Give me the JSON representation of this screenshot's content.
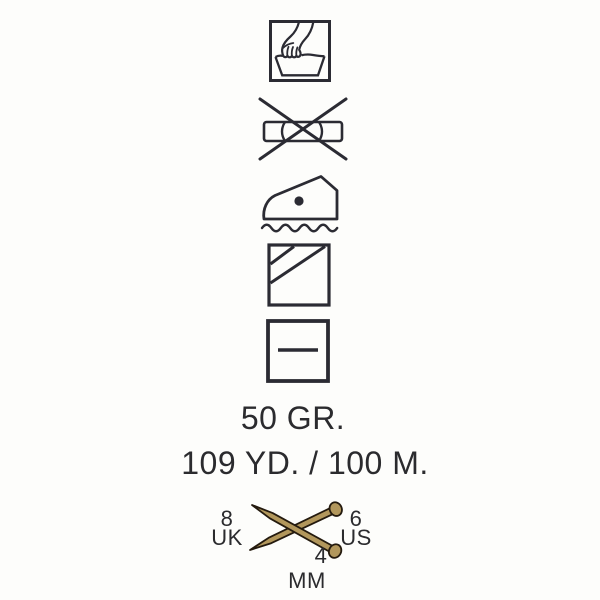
{
  "label": {
    "weight": "50 GR.",
    "yardage": "109 YD. / 100 M."
  },
  "care_symbols": [
    {
      "icon": "hand-wash-icon"
    },
    {
      "icon": "do-not-wring-icon"
    },
    {
      "icon": "iron-low-heat-steam-icon"
    },
    {
      "icon": "dry-in-shade-icon"
    },
    {
      "icon": "dry-flat-icon"
    }
  ],
  "needle_info": {
    "icon": "crossed-knitting-needles-icon",
    "uk_size": "8",
    "uk_label": "UK",
    "us_size": "6",
    "us_label": "US",
    "mm_size": "4",
    "mm_label": "MM"
  },
  "colors": {
    "background": "#fdfdfb",
    "symbol_ink": "#2b2b33",
    "text_ink": "#2b2b2e",
    "needle_fill": "#b2975c",
    "needle_outline": "#241a0e"
  }
}
